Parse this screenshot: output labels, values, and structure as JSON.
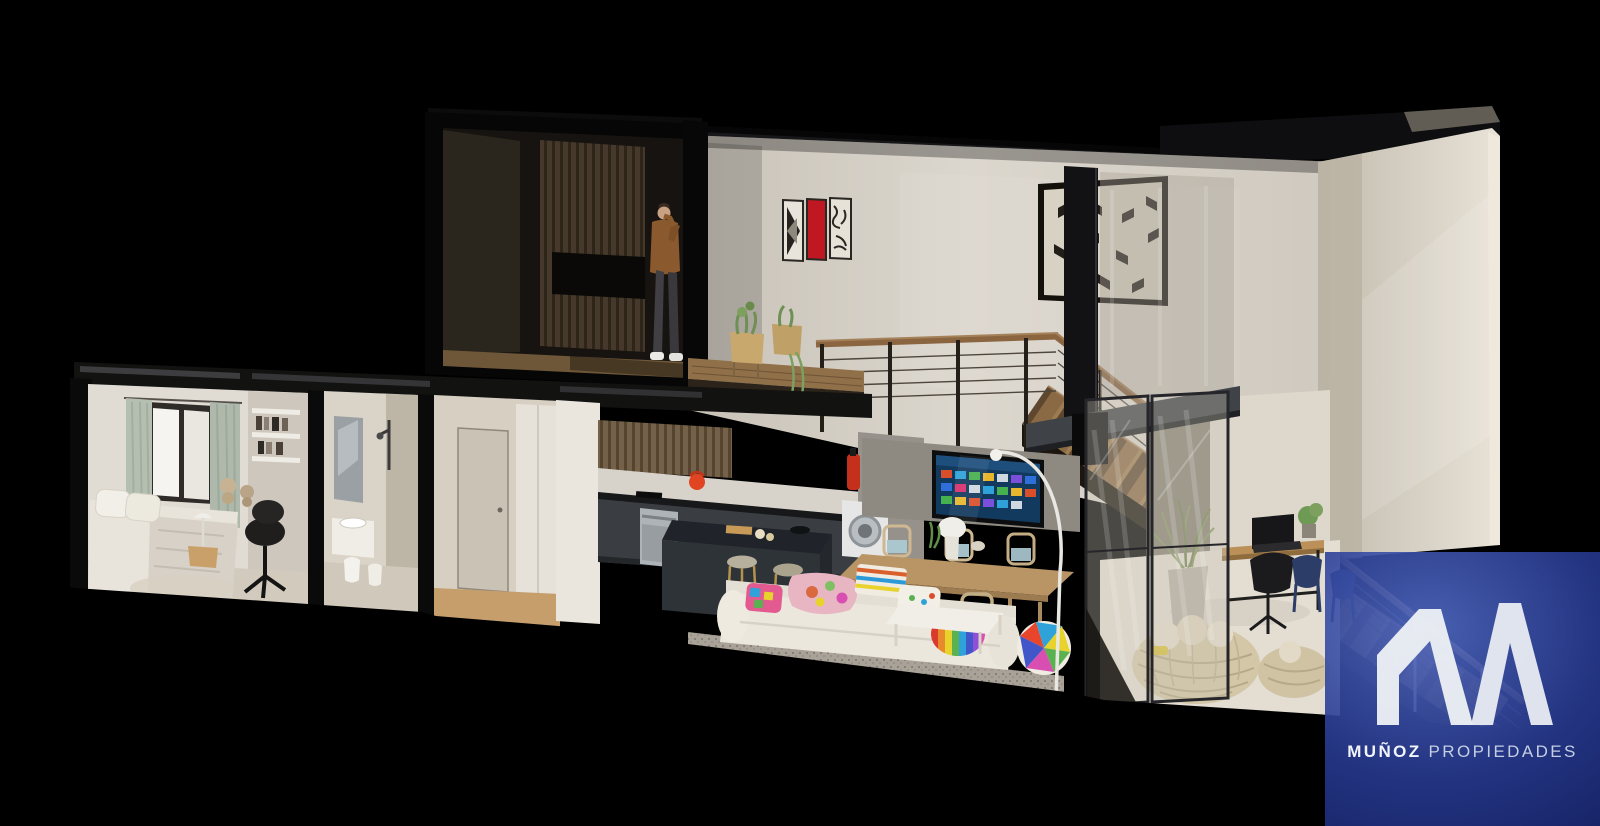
{
  "brand": {
    "logo_text_primary": "MUÑOZ",
    "logo_text_secondary": "PROPIEDADES",
    "logo_mark": "double-peak-m-monogram",
    "overlay_color": "#26388a",
    "overlay_color_deep": "#0e1856",
    "logo_color": "#edf0f6"
  },
  "colors": {
    "background": "#000000",
    "wall_light": "#ddd8cf",
    "wall_shadow": "#b9b2a6",
    "structure_dark": "#121214",
    "wood_floor": "#8f7049",
    "kitchen_cabinet": "#3a3e42",
    "accent_red_kettle": "#e04420",
    "accent_red_art": "#c01822",
    "tv_screen_blue": "#123a5e",
    "curtain_sage": "#b4bfb2",
    "stair_wood": "#8a6a45"
  },
  "scene": {
    "type": "3d-cutaway-section-render",
    "subject": "two-story loft apartment, sectioned dollhouse view on black background",
    "rooms": [
      "kids-bedroom",
      "bathroom",
      "hallway",
      "kitchen",
      "dining-area",
      "living-area",
      "home-office-terrace",
      "upper-dark-bedroom",
      "upper-landing",
      "staircase"
    ],
    "figures": [
      "man-on-phone-upper-floor"
    ]
  }
}
